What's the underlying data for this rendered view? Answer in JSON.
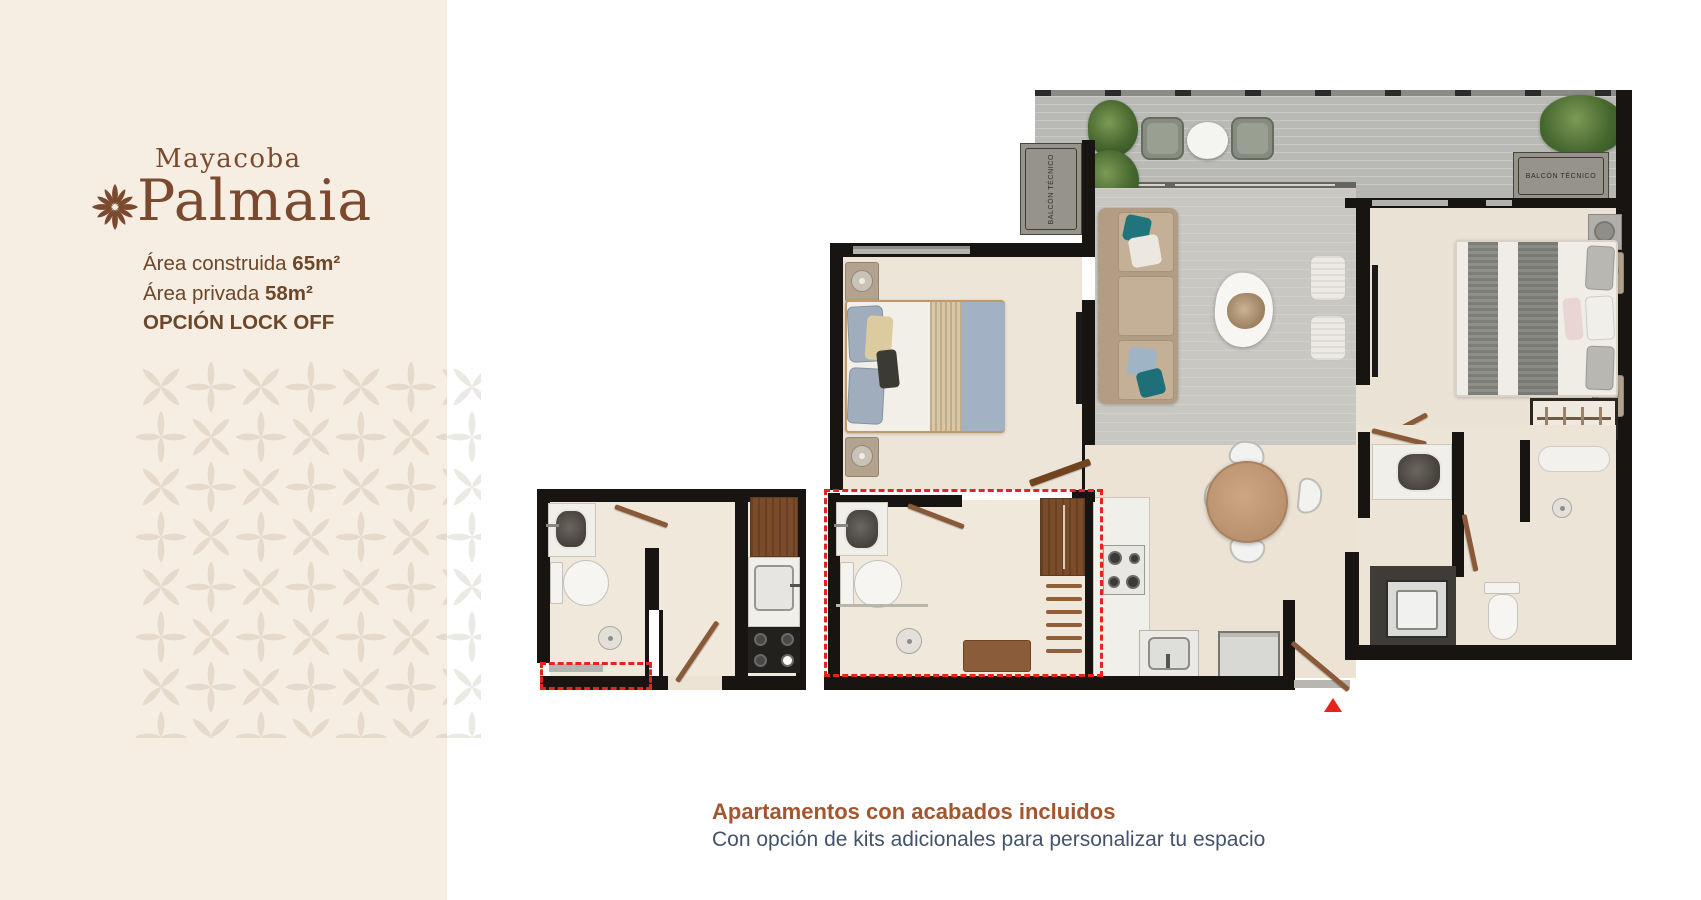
{
  "brand": {
    "pre": "Mayacoba",
    "name": "Palmaia"
  },
  "specs": {
    "built_label": "Área construida",
    "built_value": "65m²",
    "private_label": "Área privada",
    "private_value": "58m²",
    "option": "OPCIÓN LOCK OFF"
  },
  "plan": {
    "balcony_left_label": "BALCÓN TÉCNICO",
    "balcony_right_label": "BALCÓN TÉCNICO"
  },
  "footer": {
    "title": "Apartamentos con acabados incluidos",
    "subtitle": "Con opción de kits adicionales para personalizar tu espacio"
  },
  "colors": {
    "sidebar_bg": "#f6ede3",
    "brand_brown": "#7b4a2e",
    "text_brown": "#6d4729",
    "footer_title_brown": "#a3562f",
    "footer_subtitle_slate": "#43536a",
    "highlight_red": "#e8231e",
    "pattern_beige": "#e5dacb",
    "wall_black": "#171411",
    "terrace_gray": "#b9b9b5",
    "living_gray": "#c8c7c2",
    "floor_cream": "#ece3d5",
    "wood_brown": "#8a5a38"
  }
}
